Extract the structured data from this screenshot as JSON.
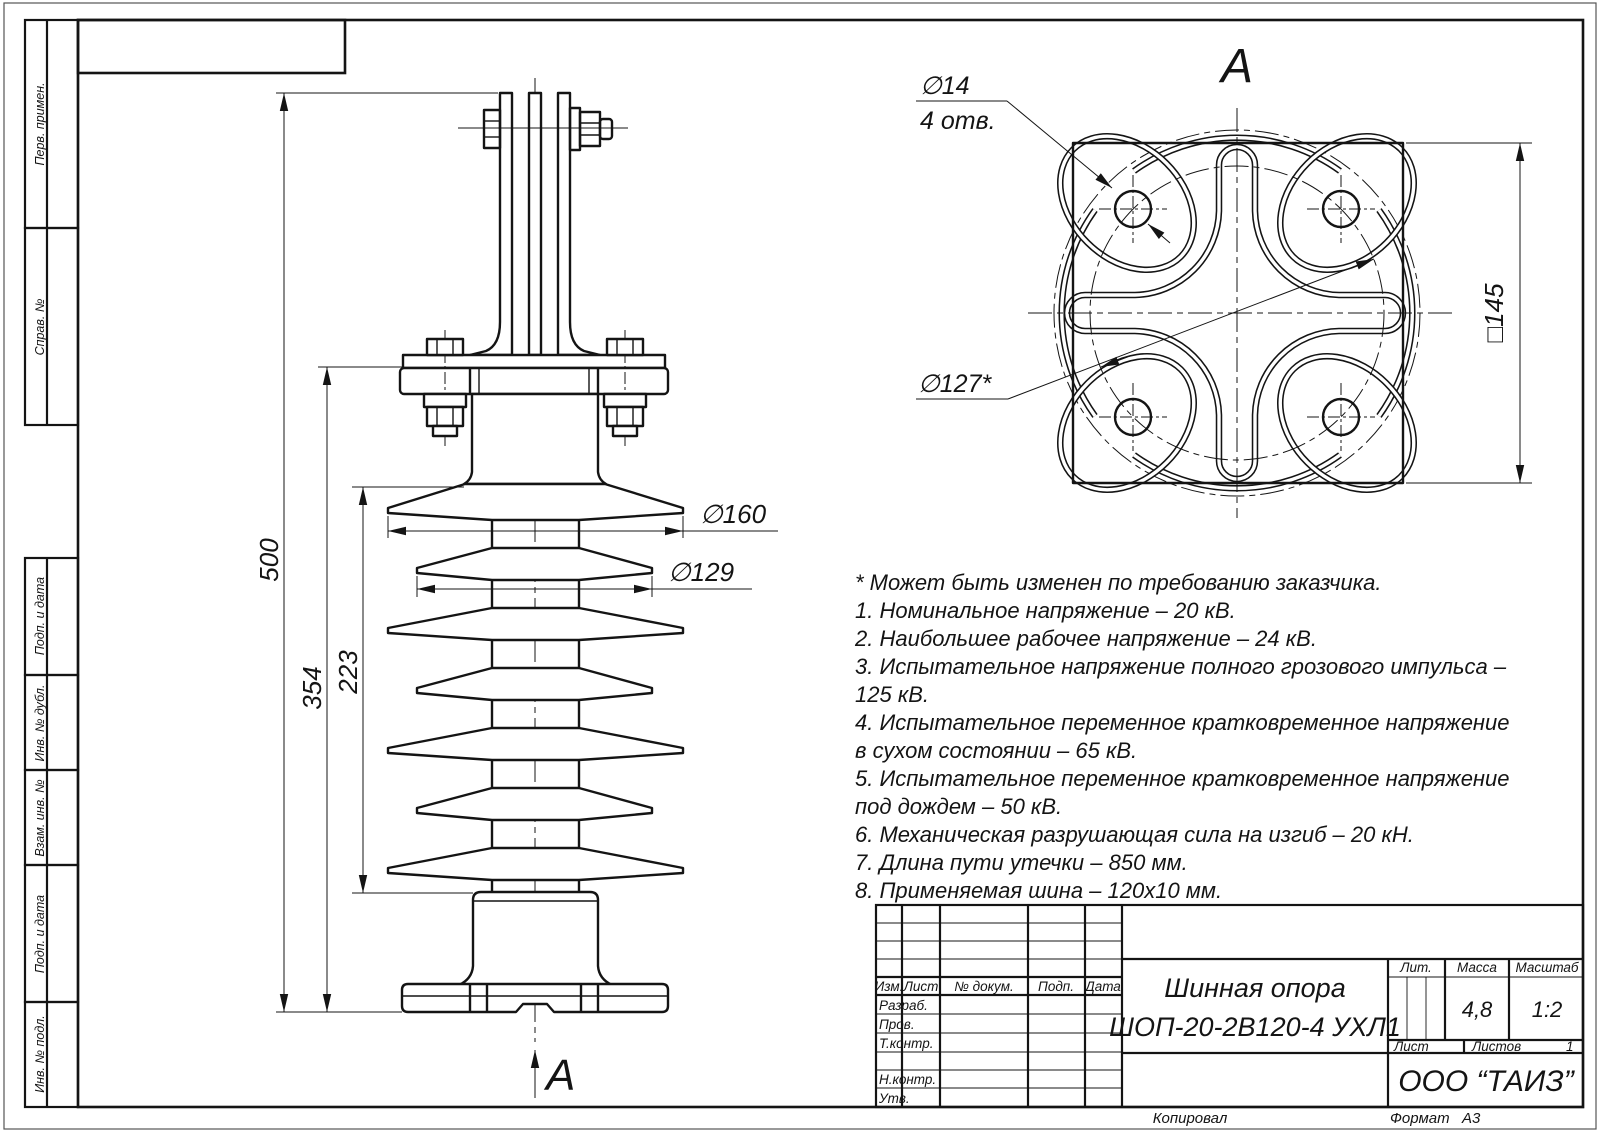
{
  "sheet": {
    "copied_label": "Копировал",
    "format_label": "Формат",
    "format_value": "А3"
  },
  "side_strip": {
    "labels": [
      "Перв. примен.",
      "Справ. №",
      "Подп. и дата",
      "Инв. № дубл.",
      "Взам. инв. №",
      "Подп. и дата",
      "Инв. № подл."
    ]
  },
  "views": {
    "front": {
      "arrow_label": "А"
    },
    "top": {
      "title": "А"
    }
  },
  "dimensions": {
    "front": {
      "h500": "500",
      "h354": "354",
      "h223": "223",
      "d160": "∅160",
      "d129": "∅129"
    },
    "top": {
      "d14": "∅14",
      "holes_count": "4 отв.",
      "bolt_circle": "∅127*",
      "square": "□145"
    }
  },
  "notes": {
    "lines": [
      "* Может быть изменен по требованию заказчика.",
      "1. Номинальное напряжение – 20 кВ.",
      "2. Наибольшее рабочее напряжение – 24 кВ.",
      "3. Испытательное напряжение полного грозового импульса –",
      "125 кВ.",
      "4. Испытательное переменное кратковременное напряжение",
      "в сухом состоянии – 65 кВ.",
      "5. Испытательное переменное кратковременное напряжение",
      "под дождем – 50 кВ.",
      "6. Механическая разрушающая сила на изгиб – 20 кН.",
      "7. Длина пути утечки – 850 мм.",
      "8. Применяемая шина – 120х10 мм."
    ]
  },
  "title_block": {
    "columns": {
      "izm": "Изм.",
      "list": "Лист",
      "n_dokum": "№ докум.",
      "podp": "Подп.",
      "data": "Дата"
    },
    "rows": {
      "razrab": "Разраб.",
      "prov": "Пров.",
      "tkontr": "Т.контр.",
      "nkontr": "Н.контр.",
      "utv": "Утв."
    },
    "title_line1": "Шинная опора",
    "title_line2": "ШОП-20-2В120-4 УХЛ1",
    "lit_label": "Лит.",
    "massa_label": "Масса",
    "masshtab_label": "Масштаб",
    "massa_value": "4,8",
    "masshtab_value": "1:2",
    "list_label": "Лист",
    "listov_label": "Листов",
    "listov_value": "1",
    "company": "ООО “ТАИЗ”"
  }
}
